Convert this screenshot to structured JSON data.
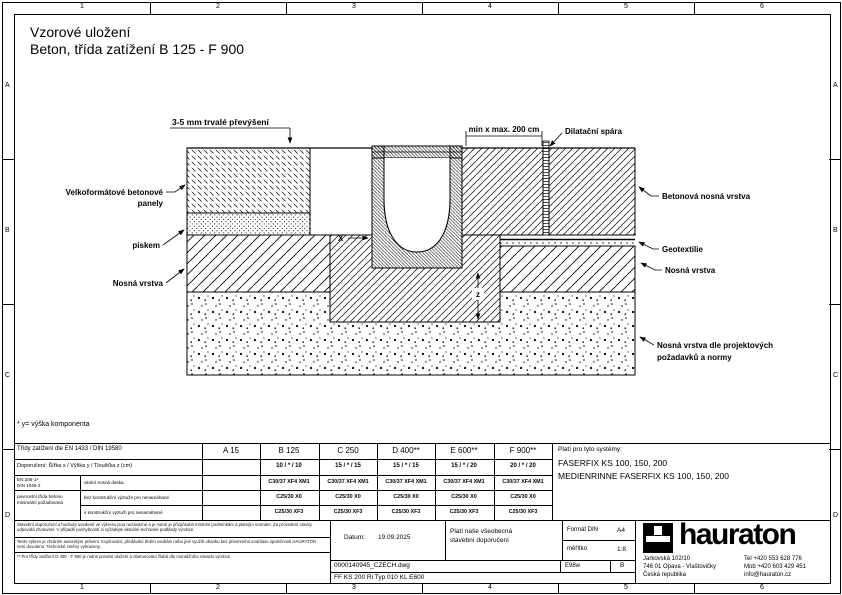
{
  "page": {
    "title_line1": "Vzorové uložení",
    "title_line2": "Beton, třída zatížení B 125  - F 900",
    "footnote": "* y= výška komponenta"
  },
  "frame": {
    "columns": [
      "1",
      "2",
      "3",
      "4",
      "5",
      "6"
    ],
    "rows": [
      "A",
      "B",
      "C",
      "D"
    ]
  },
  "drawing": {
    "labels": {
      "elevation": "3-5 mm trvalé převýšení",
      "dim_top": "min x max. 200 cm",
      "expansion_joint": "Dilatační spára",
      "panels_line1": "Velkoformátové betonové",
      "panels_line2": "panely",
      "sand": "pískem",
      "base_left": "Nosná vrstva",
      "concrete_base": "Betonová nosná vrstva",
      "geotextile": "Geotextilie",
      "base_right": "Nosná vrstva",
      "subgrade_line1": "Nosná vrstva dle projektových",
      "subgrade_line2": "požadavků a normy",
      "dim_x": "X",
      "dim_z": "z"
    }
  },
  "table": {
    "class_row_label": "Třídy zatížení dle EN 1433 / DIN 19580",
    "classes": [
      "A 15",
      "B 125",
      "C 250",
      "D 400**",
      "E 600**",
      "F 900**"
    ],
    "dimension_row_label": "Doporučení:  Šířka x / Výška y / Tloušťka z (cm)",
    "dimensions": [
      "",
      "10 / * / 10",
      "15 / * / 15",
      "15 / * / 15",
      "15 / * / 20",
      "20 / * / 20"
    ],
    "norm_label_line1": "EN 206-1+",
    "norm_label_line2": "DIN 1045-2",
    "norm_sub_line1": "pevnostní třída betonu",
    "norm_sub_line2": "minimální požadovaná",
    "rows": [
      {
        "label": "okolní nosná deska",
        "values": [
          "",
          "C30/37 XF4 XM1",
          "C30/37 XF4 XM1",
          "C30/37 XF4 XM1",
          "C30/37 XF4 XM1",
          "C30/37 XF4 XM1"
        ]
      },
      {
        "label": "bez konstrukční výztuže pro nenamáhané",
        "values": [
          "",
          "C25/30 X0",
          "C25/30 X0",
          "C25/30 X0",
          "C25/30 X0",
          "C25/30 X0"
        ]
      },
      {
        "label": "s konstrukční výztuží pro nenamáhané",
        "values": [
          "",
          "C25/30 XF3",
          "C25/30 XF3",
          "C25/30 XF3",
          "C25/30 XF3",
          "C25/30 XF3"
        ]
      }
    ]
  },
  "systems": {
    "heading": "Platí pro tyto systémy:",
    "item1": "FASERFIX KS 100, 150, 200",
    "item2": "MEDIENRINNE FASERFIX KS 100, 150, 200"
  },
  "titleblock": {
    "disclaimer1": "Stavební doporučení a hodnoty uvedené ve výkresu jsou nezávazné a je nutné je přizpůsobit místním podmínkám a platným normám. Za provedení stavby odpovídá zhotovitel. V případě pochybností si vyžádejte aktuální technické podklady výrobce.",
    "disclaimer2": "Tento výkres je chráněn autorským právem. Kopírování, předávání třetím osobám nebo jiné využití obsahu bez písemného souhlasu společnosti HAURATON není dovoleno. Technické změny vyhrazeny.",
    "disclaimer3": "** Pro třídy zatížení D 400 - F 900 je nutné provést uložení a obetonování žlabů dle montážního návodu výrobce.",
    "date_label": "Datum:",
    "date_value": "19.09.2025",
    "note_line1": "Platí naše všeobecná",
    "note_line2": "stavební doporučení",
    "format_label": "Formát DIN",
    "format_value": "A4",
    "scale_label": "měřítko",
    "scale_value": "1:8",
    "file_name": "0000140945_CZECH.dwg",
    "code": "E98w",
    "revision": "B",
    "type_line": "FF  KS 200 Ri Typ 010 KL E600",
    "logo_text": "hauraton",
    "address1": "Jarkovská 102/10",
    "address2": "746 01 Opava - Vlaštovičky",
    "address3": "Česká republika",
    "contact1": "Tel  +420 553 628 776",
    "contact2": "Mob +420 603 429 451",
    "contact3": "info@hauraton.cz"
  }
}
